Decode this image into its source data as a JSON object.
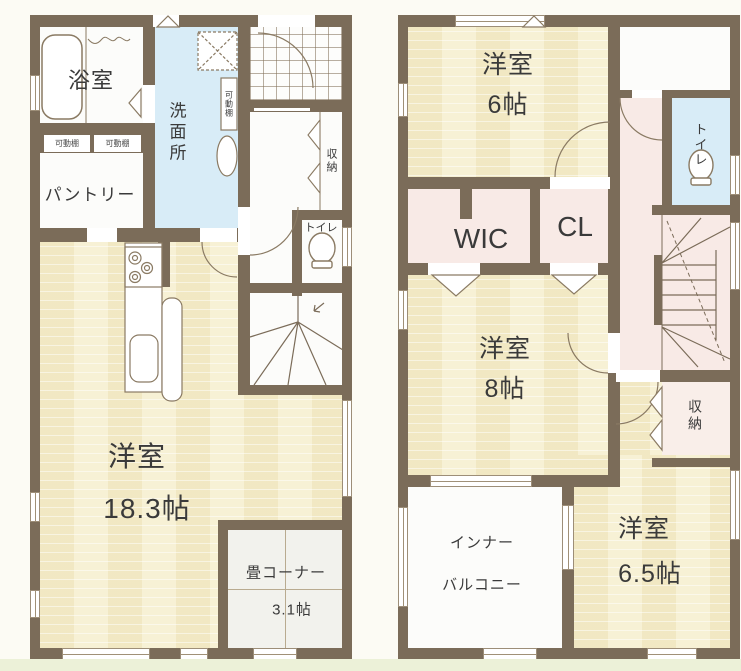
{
  "colors": {
    "wall": "#7b6c59",
    "floor_wood": "#f5eecb",
    "hall_pink": "#f8eae6",
    "wet_blue": "#d8ecf7",
    "tatami": "#f2f2ed",
    "ground": "#ecf1d8"
  },
  "floor1": {
    "bathroom": "浴室",
    "shelf_a": "可動棚",
    "shelf_b": "可動棚",
    "shelf_c": "可動棚",
    "pantry": "パントリー",
    "washroom": "洗面所",
    "storage": "収納",
    "toilet": "トイレ",
    "living_label": "洋室",
    "living_size": "18.3帖",
    "tatami_label": "畳コーナー",
    "tatami_size": "3.1帖"
  },
  "floor2": {
    "bedroom6_label": "洋室",
    "bedroom6_size": "6帖",
    "wic": "WIC",
    "cl": "CL",
    "toilet": "トイレ",
    "bedroom8_label": "洋室",
    "bedroom8_size": "8帖",
    "storage": "収納",
    "balcony_line1": "インナー",
    "balcony_line2": "バルコニー",
    "bedroom65_label": "洋室",
    "bedroom65_size": "6.5帖"
  }
}
